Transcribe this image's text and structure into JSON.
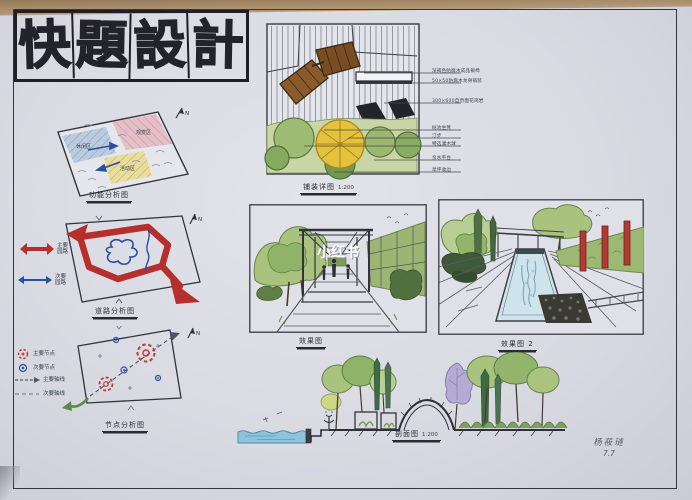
{
  "board": {
    "title_chars": [
      "快",
      "題",
      "設",
      "計"
    ]
  },
  "analysis": {
    "function": {
      "caption": "功能分析图",
      "zones": [
        "休闲区",
        "观赏区",
        "活动区"
      ],
      "north": "N"
    },
    "road": {
      "caption": "道路分析图",
      "legend": [
        {
          "label": "主要园路",
          "color": "#b5302c"
        },
        {
          "label": "次要园路",
          "color": "#2b4fa0"
        }
      ],
      "north": "N"
    },
    "node": {
      "caption": "节点分析图",
      "legend": [
        {
          "label": "主要节点"
        },
        {
          "label": "次要节点"
        },
        {
          "label": "主要轴线"
        },
        {
          "label": "次要轴线"
        }
      ],
      "north": "N"
    }
  },
  "detail_plan": {
    "caption": "铺装详图",
    "scale": "1:200",
    "annotations": [
      "深褐色防腐木成品躺椅",
      "50×50防腐木龙骨铺装",
      "300×600自然面花岗岩",
      "树池坐凳",
      "汀步",
      "特选灌木球",
      "亲水平台",
      "草坪收边"
    ]
  },
  "perspectives": {
    "one": {
      "caption": "效果图",
      "watermark": "小红书"
    },
    "two": {
      "caption": "效果图 2"
    }
  },
  "section": {
    "caption": "剖面图",
    "scale": "1:200"
  },
  "signature": {
    "name": "杨莜琏",
    "date": "7.7"
  },
  "colors": {
    "marker_red": "#b5302c",
    "pen_blue": "#2b4fa0",
    "tree_green": "#8fb468",
    "wood_brown": "#8a5a2b",
    "water_blue": "#8fc3da",
    "paper": "#d9dae2",
    "table_wood": "#b3977a"
  }
}
